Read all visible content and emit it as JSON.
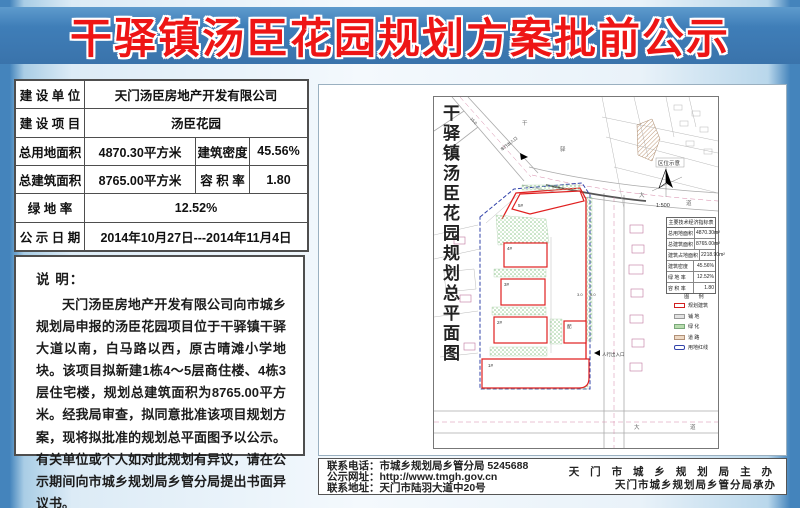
{
  "banner": {
    "title": "干驿镇汤臣花园规划方案批前公示"
  },
  "info_table": {
    "rows": [
      {
        "label": "建 设 单 位",
        "value": "天门汤臣房地产开发有限公司"
      },
      {
        "label": "建 设 项 目",
        "value": "汤臣花园"
      },
      {
        "label": "总用地面积",
        "value": "4870.30平方米",
        "label2": "建筑密度",
        "value2": "45.56%"
      },
      {
        "label": "总建筑面积",
        "value": "8765.00平方米",
        "label2": "容 积 率",
        "value2": "1.80"
      },
      {
        "label": "绿 地 率",
        "value": "12.52%"
      },
      {
        "label": "公 示 日 期",
        "value": "2014年10月27日---2014年11月4日"
      }
    ]
  },
  "notes": {
    "heading": "说        明：",
    "body": "天门汤臣房地产开发有限公司向市城乡规划局申报的汤臣花园项目位于干驿镇干驿大道以南，白马路以西，原古晴滩小学地块。该项目拟新建1栋4～5层商住楼、4栋3层住宅楼，规划总建筑面积为8765.00平方米。经我局审查，拟同意批准该项目规划方案，现将拟批准的规划总平面图予以公示。有关单位或个人如对此规划有异议，请在公示期间向市城乡规划局乡管分局提出书面异议书。"
  },
  "map": {
    "title": "干驿镇汤臣花园规划总平面图",
    "scale": "1:500",
    "location_label": "区位示意",
    "indicator_table": {
      "title": "主要技术经济指标表",
      "rows": [
        [
          "总用地面积",
          "4870.30m²"
        ],
        [
          "总建筑面积",
          "8765.00m²"
        ],
        [
          "建筑占地面积",
          "2218.90m²"
        ],
        [
          "建筑密度",
          "45.56%"
        ],
        [
          "绿 地 率",
          "12.52%"
        ],
        [
          "容 积 率",
          "1.80"
        ]
      ]
    },
    "legend": {
      "title": "图  例",
      "items": [
        "规划建筑",
        "铺  地",
        "绿  化",
        "道  路",
        "用地红线"
      ]
    },
    "buildings": [
      "5#",
      "4#",
      "3#",
      "2#",
      "1#",
      "配"
    ],
    "entrances": {
      "vehicle": "车行出入口",
      "pedestrian": "人行出入口"
    },
    "road_labels": [
      "干",
      "驿",
      "大",
      "道"
    ],
    "dims": [
      "15.0",
      "3.0",
      "6.0"
    ]
  },
  "footer": {
    "lines": [
      "联系电话：市城乡规划局乡管分局  5245688",
      "公示网址：http://www.tmgh.gov.cn",
      "联系地址：天门市陆羽大道中20号"
    ],
    "right": [
      "天 门 市 城 乡 规 划 局 主 办",
      "天门市城乡规划局乡管分局承办"
    ]
  },
  "colors": {
    "banner_bg": "#3f7eb8",
    "title_red": "#ee1515",
    "page_edge_blue": "#4484bc",
    "boundary_red": "#e02020",
    "redline_blue": "#3344aa",
    "greenery": "#8bc48b"
  }
}
